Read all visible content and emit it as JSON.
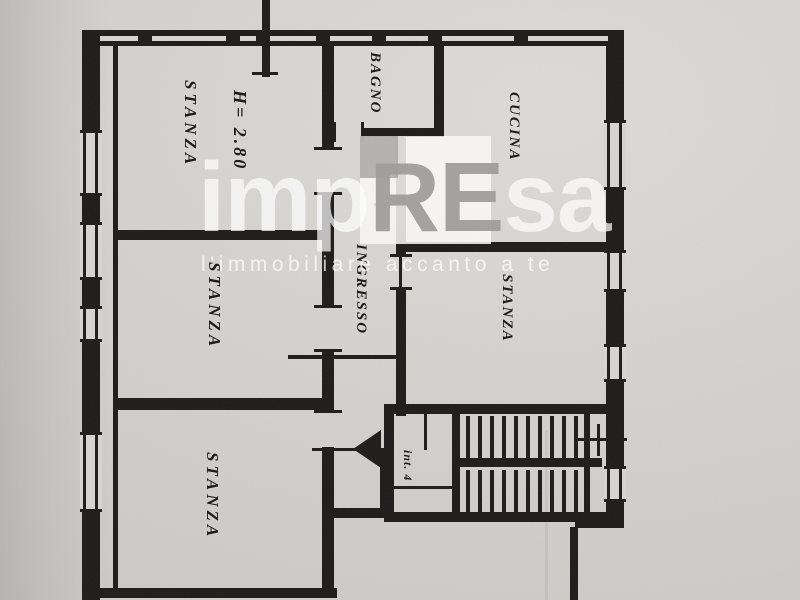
{
  "colors": {
    "paper": "#d3d2cf",
    "ink": "#1d1c1a",
    "watermark_white": "rgba(255,255,255,0.75)",
    "watermark_gray": "#9e9d9a"
  },
  "rooms": {
    "stanza_top_left": {
      "label": "STANZA",
      "height_note": "H= 2.80"
    },
    "stanza_middle_left": {
      "label": "STANZA"
    },
    "stanza_bottom_left": {
      "label": "STANZA"
    },
    "bagno": {
      "label": "BAGNO"
    },
    "cucina": {
      "label": "CUCINA"
    },
    "stanza_right": {
      "label": "STANZA"
    },
    "ingresso": {
      "label": "INGRESSO"
    },
    "stairwell": {
      "unit_note": "int. 4"
    }
  },
  "watermark": {
    "brand_prefix": "imp",
    "brand_highlight": "RE",
    "brand_suffix": "sa",
    "tagline": "l'immobiliare accanto a te"
  }
}
